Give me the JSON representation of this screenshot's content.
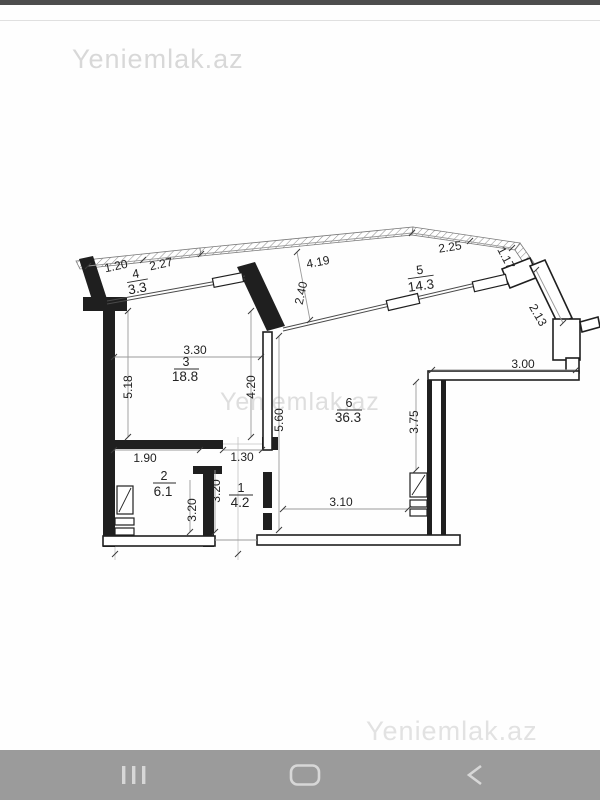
{
  "watermarks": {
    "top": "Yeniemlak.az",
    "middle": "Yeniemlak.az",
    "bottom": "Yeniemlak.az"
  },
  "colors": {
    "nav_bar_bg": "#9b9b9b",
    "nav_icon": "#d7d7d7",
    "status_strip": "#4d4d4d",
    "watermark": "#dcdcdc",
    "plan_line": "#1f1f1f"
  },
  "nav_bar": {
    "icons": [
      {
        "name": "recents-icon"
      },
      {
        "name": "home-icon"
      },
      {
        "name": "back-icon"
      }
    ]
  },
  "floor_plan": {
    "rooms": [
      {
        "number": "1",
        "area": "4.2"
      },
      {
        "number": "2",
        "area": "6.1"
      },
      {
        "number": "3",
        "area": "18.8"
      },
      {
        "number": "4",
        "area": "3.3"
      },
      {
        "number": "5",
        "area": "14.3"
      },
      {
        "number": "6",
        "area": "36.3"
      }
    ],
    "dimensions": {
      "balcony4_a": "1.20",
      "balcony4_b": "2.27",
      "balcony5_top": "4.19",
      "balcony5_right_a": "2.25",
      "balcony5_right_b": "1.17",
      "balcony5_depth": "2.40",
      "right_wall_slant": "2.13",
      "room3_width": "3.30",
      "room3_left": "5.18",
      "room3_right": "4.20",
      "room6_left": "5.60",
      "nook_top": "3.00",
      "room6_right": "3.75",
      "room2_top": "1.90",
      "hall_top": "1.30",
      "room2_side": "3.20",
      "hall_side": "3.20",
      "room6_bottom": "3.10"
    }
  }
}
